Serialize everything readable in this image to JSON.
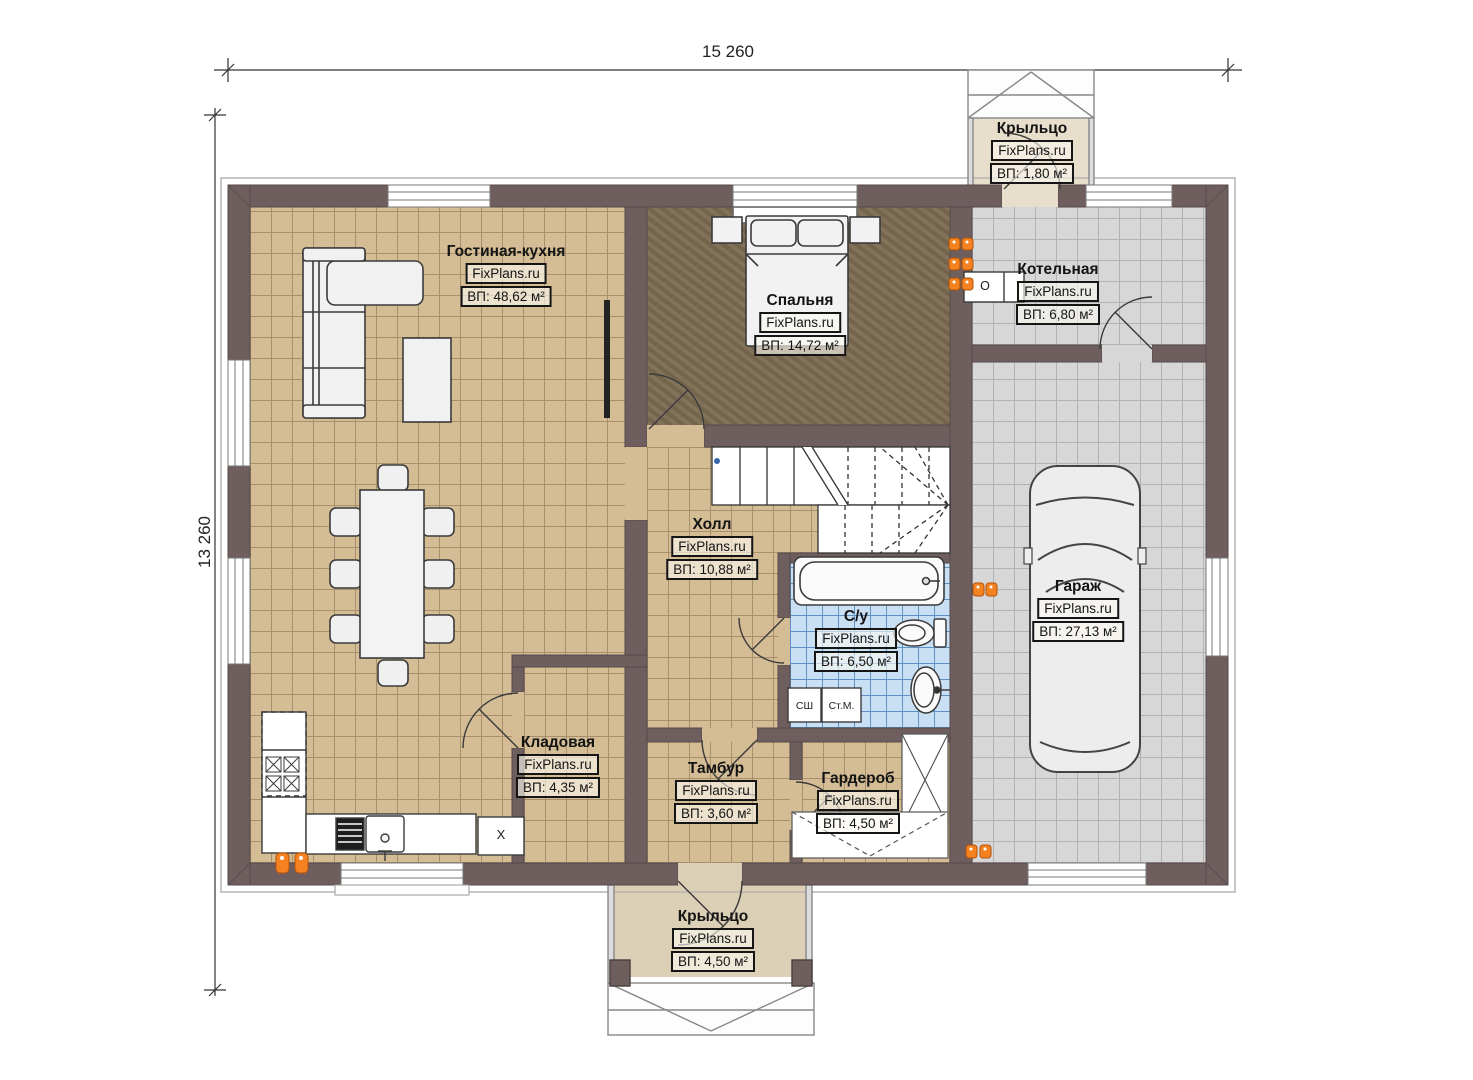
{
  "plan": {
    "dimensions": {
      "width": "15 260",
      "height": "13 260"
    },
    "rooms": [
      {
        "key": "living",
        "name": "Гостиная-кухня",
        "brand": "FixPlans.ru",
        "area": "ВП: 48,62 м²"
      },
      {
        "key": "bedroom",
        "name": "Спальня",
        "brand": "FixPlans.ru",
        "area": "ВП: 14,72 м²"
      },
      {
        "key": "boiler",
        "name": "Котельная",
        "brand": "FixPlans.ru",
        "area": "ВП: 6,80 м²"
      },
      {
        "key": "hall",
        "name": "Холл",
        "brand": "FixPlans.ru",
        "area": "ВП: 10,88 м²"
      },
      {
        "key": "garage",
        "name": "Гараж",
        "brand": "FixPlans.ru",
        "area": "ВП: 27,13 м²"
      },
      {
        "key": "bathroom",
        "name": "С/у",
        "brand": "FixPlans.ru",
        "area": "ВП: 6,50 м²"
      },
      {
        "key": "storage",
        "name": "Кладовая",
        "brand": "FixPlans.ru",
        "area": "ВП: 4,35 м²"
      },
      {
        "key": "vestibule",
        "name": "Тамбур",
        "brand": "FixPlans.ru",
        "area": "ВП: 3,60 м²"
      },
      {
        "key": "wardrobe",
        "name": "Гардероб",
        "brand": "FixPlans.ru",
        "area": "ВП: 4,50 м²"
      },
      {
        "key": "porch_top",
        "name": "Крыльцо",
        "brand": "FixPlans.ru",
        "area": "ВП: 1,80 м²"
      },
      {
        "key": "porch_bottom",
        "name": "Крыльцо",
        "brand": "FixPlans.ru",
        "area": "ВП: 4,50 м²"
      }
    ],
    "markers": {
      "dryer": "СШ",
      "washer": "Ст.М.",
      "cabinet": "X",
      "boiler_unit": "О"
    },
    "colors": {
      "wall": "#6e5f5e",
      "floor_tan": "#d4bd95",
      "floor_dark": "#7b6a51",
      "floor_gray": "#d7d7d7",
      "floor_blue": "#c9dff3",
      "porch": "#dbcfb5",
      "radiator": "#f58220"
    }
  }
}
